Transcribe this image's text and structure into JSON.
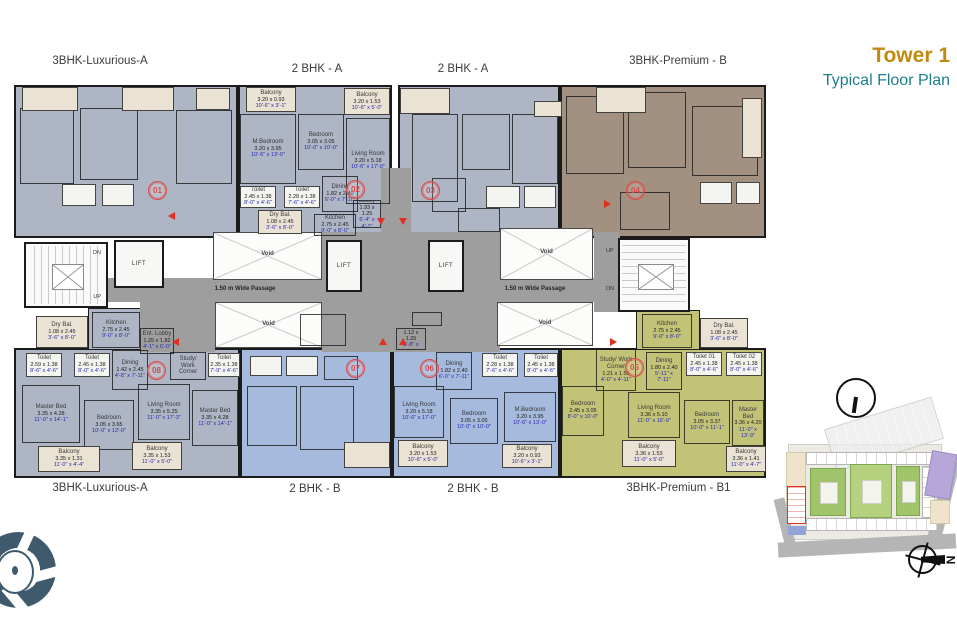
{
  "title": {
    "tower": "Tower 1",
    "plan": "Typical Floor Plan"
  },
  "unit_types": {
    "top": [
      "3BHK-Luxurious-A",
      "2 BHK - A",
      "2 BHK - A",
      "3BHK-Premium - B"
    ],
    "bottom": [
      "3BHK-Luxurious-A",
      "2 BHK - B",
      "2 BHK - B",
      "3BHK-Premium - B1"
    ]
  },
  "core": {
    "lift": "LIFT",
    "void": "Void",
    "up": "UP",
    "dn": "DN",
    "passage": "1.50 m Wide Passage",
    "north": "N"
  },
  "colors": {
    "slate_unit": "#aeb5c4",
    "periwinkle_unit": "#a6bade",
    "brown_unit": "#a29080",
    "olive_unit": "#c2c377",
    "balcony": "#eae2d3",
    "corridor": "#9e9e9e",
    "unit_badge": "#d84b4b",
    "imperial_dim": "#2929b0",
    "tower_gold": "#c08a10",
    "subtitle_teal": "#1e7d8d"
  },
  "units": [
    {
      "number": "01",
      "x": 148,
      "y": 181
    },
    {
      "number": "02",
      "x": 346,
      "y": 180
    },
    {
      "number": "03",
      "x": 421,
      "y": 181
    },
    {
      "number": "04",
      "x": 626,
      "y": 181
    },
    {
      "number": "05",
      "x": 625,
      "y": 358
    },
    {
      "number": "06",
      "x": 420,
      "y": 359
    },
    {
      "number": "07",
      "x": 346,
      "y": 359
    },
    {
      "number": "08",
      "x": 147,
      "y": 361
    }
  ],
  "arrows": [
    {
      "x": 377,
      "y": 218,
      "d": "down"
    },
    {
      "x": 399,
      "y": 218,
      "d": "down"
    },
    {
      "x": 379,
      "y": 338,
      "d": "up"
    },
    {
      "x": 399,
      "y": 338,
      "d": "up"
    },
    {
      "x": 168,
      "y": 212,
      "d": "left"
    },
    {
      "x": 604,
      "y": 200,
      "d": "right"
    },
    {
      "x": 610,
      "y": 338,
      "d": "right"
    },
    {
      "x": 172,
      "y": 338,
      "d": "left"
    }
  ],
  "rooms": [
    {
      "x": 20,
      "y": 108,
      "w": 54,
      "h": 76
    },
    {
      "x": 80,
      "y": 108,
      "w": 58,
      "h": 72
    },
    {
      "x": 176,
      "y": 110,
      "w": 56,
      "h": 74
    },
    {
      "x": 62,
      "y": 184,
      "w": 34,
      "h": 22,
      "b": "w"
    },
    {
      "x": 102,
      "y": 184,
      "w": 32,
      "h": 22,
      "b": "w"
    },
    {
      "x": 22,
      "y": 87,
      "w": 56,
      "h": 24,
      "b": "b"
    },
    {
      "x": 122,
      "y": 87,
      "w": 52,
      "h": 24,
      "b": "b"
    },
    {
      "x": 196,
      "y": 88,
      "w": 34,
      "h": 22,
      "b": "b"
    },
    {
      "x": 246,
      "y": 87,
      "w": 50,
      "h": 25,
      "b": "b",
      "n": "Balcony",
      "m": "3.20 x 0.93",
      "f": "10'-6\" x 3'-1\""
    },
    {
      "x": 344,
      "y": 88,
      "w": 46,
      "h": 27,
      "b": "b",
      "n": "Balcony",
      "m": "3.20 x 1.53",
      "f": "10'-6\" x 5'-0\""
    },
    {
      "x": 240,
      "y": 114,
      "w": 56,
      "h": 70,
      "n": "M.Bedroom",
      "m": "3.20 x 3.95",
      "f": "10'-6\" x 13'-0\""
    },
    {
      "x": 298,
      "y": 114,
      "w": 46,
      "h": 56,
      "n": "Bedroom",
      "m": "3.05 x 3.05",
      "f": "10'-0\" x 10'-0\""
    },
    {
      "x": 346,
      "y": 118,
      "w": 44,
      "h": 86,
      "n": "Living Room",
      "m": "3.20 x 5.18",
      "f": "10'-6\" x 17'-0\""
    },
    {
      "x": 240,
      "y": 186,
      "w": 36,
      "h": 22,
      "b": "w",
      "n": "Toilet",
      "m": "2.45 x 1.38",
      "f": "8'-0\" x 4'-6\""
    },
    {
      "x": 284,
      "y": 186,
      "w": 36,
      "h": 22,
      "b": "w",
      "n": "Toilet",
      "m": "2.28 x 1.38",
      "f": "7'-6\" x 4'-6\""
    },
    {
      "x": 322,
      "y": 176,
      "w": 36,
      "h": 36,
      "n": "Dining",
      "m": "1.82 x 2.40",
      "f": "6'-0\" x 7'-11\""
    },
    {
      "x": 258,
      "y": 210,
      "w": 44,
      "h": 24,
      "b": "b",
      "n": "Dry Bal.",
      "m": "1.08 x 2.45",
      "f": "3'-6\" x 8'-0\""
    },
    {
      "x": 314,
      "y": 214,
      "w": 42,
      "h": 22,
      "n": "Kitchen",
      "m": "2.75 x 2.45",
      "f": "9'-0\" x 8'-0\""
    },
    {
      "x": 353,
      "y": 200,
      "w": 28,
      "h": 28,
      "n": "Lobby",
      "m": "1.93 x 1.25",
      "f": "6'-4\" x 4'-1\""
    },
    {
      "x": 412,
      "y": 114,
      "w": 46,
      "h": 88
    },
    {
      "x": 462,
      "y": 114,
      "w": 48,
      "h": 56
    },
    {
      "x": 512,
      "y": 114,
      "w": 46,
      "h": 70
    },
    {
      "x": 486,
      "y": 186,
      "w": 34,
      "h": 22,
      "b": "w"
    },
    {
      "x": 524,
      "y": 186,
      "w": 32,
      "h": 22,
      "b": "w"
    },
    {
      "x": 432,
      "y": 178,
      "w": 34,
      "h": 34
    },
    {
      "x": 458,
      "y": 208,
      "w": 42,
      "h": 24
    },
    {
      "x": 400,
      "y": 88,
      "w": 50,
      "h": 26,
      "b": "b"
    },
    {
      "x": 534,
      "y": 101,
      "w": 28,
      "h": 16,
      "b": "b"
    },
    {
      "x": 566,
      "y": 96,
      "w": 58,
      "h": 78
    },
    {
      "x": 628,
      "y": 92,
      "w": 58,
      "h": 76
    },
    {
      "x": 692,
      "y": 106,
      "w": 66,
      "h": 70
    },
    {
      "x": 700,
      "y": 182,
      "w": 32,
      "h": 22,
      "b": "w"
    },
    {
      "x": 736,
      "y": 182,
      "w": 24,
      "h": 22,
      "b": "w"
    },
    {
      "x": 620,
      "y": 192,
      "w": 50,
      "h": 38
    },
    {
      "x": 596,
      "y": 87,
      "w": 50,
      "h": 26,
      "b": "b"
    },
    {
      "x": 742,
      "y": 98,
      "w": 20,
      "h": 60,
      "b": "b"
    },
    {
      "x": 26,
      "y": 353,
      "w": 36,
      "h": 24,
      "b": "w",
      "n": "Toilet",
      "m": "2.59 x 1.38",
      "f": "8'-6\" x 4'-6\""
    },
    {
      "x": 74,
      "y": 353,
      "w": 36,
      "h": 24,
      "b": "w",
      "n": "Toilet",
      "m": "2.45 x 1.38",
      "f": "8'-0\" x 4'-6\""
    },
    {
      "x": 112,
      "y": 350,
      "w": 36,
      "h": 40,
      "n": "Dining",
      "m": "1.42 x 2.45",
      "f": "4'-8\" x 7'-11\""
    },
    {
      "x": 170,
      "y": 352,
      "w": 36,
      "h": 28,
      "n": "Study/ Work Corner"
    },
    {
      "x": 208,
      "y": 353,
      "w": 32,
      "h": 24,
      "b": "w",
      "n": "Toilet",
      "m": "2.35 x 1.38",
      "f": "7'-9\" x 4'-6\""
    },
    {
      "x": 22,
      "y": 385,
      "w": 58,
      "h": 58,
      "n": "Master Bed",
      "m": "3.35 x 4.28",
      "f": "11'-0\" x 14'-1\""
    },
    {
      "x": 84,
      "y": 400,
      "w": 50,
      "h": 50,
      "n": "Bedroom",
      "m": "3.05 x 3.65",
      "f": "10'-0\" x 12'-0\""
    },
    {
      "x": 138,
      "y": 384,
      "w": 52,
      "h": 56,
      "n": "Living Room",
      "m": "3.35 x 5.25",
      "f": "11'-0\" x 17'-3\""
    },
    {
      "x": 192,
      "y": 390,
      "w": 46,
      "h": 56,
      "n": "Master Bed",
      "m": "3.35 x 4.28",
      "f": "11'-0\" x 14'-1\""
    },
    {
      "x": 38,
      "y": 446,
      "w": 62,
      "h": 26,
      "b": "b",
      "n": "Balcony",
      "m": "3.35 x 1.31",
      "f": "11'-0\" x 4'-4\""
    },
    {
      "x": 132,
      "y": 442,
      "w": 50,
      "h": 28,
      "b": "b",
      "n": "Balcony",
      "m": "3.35 x 1.53",
      "f": "11'-0\" x 5'-0\""
    },
    {
      "x": 140,
      "y": 328,
      "w": 34,
      "h": 26,
      "n": "Ent. Lobby",
      "m": "1.25 x 1.82",
      "f": "4'-1\" x 6'-0\""
    },
    {
      "x": 92,
      "y": 312,
      "w": 48,
      "h": 36,
      "n": "Kitchen",
      "m": "2.75 x 2.45",
      "f": "9'-0\" x 8'-0\""
    },
    {
      "x": 36,
      "y": 316,
      "w": 52,
      "h": 32,
      "b": "b",
      "n": "Dry Bal.",
      "m": "1.08 x 2.45",
      "f": "3'-6\" x 8'-0\""
    },
    {
      "x": 247,
      "y": 386,
      "w": 50,
      "h": 60
    },
    {
      "x": 300,
      "y": 386,
      "w": 54,
      "h": 64
    },
    {
      "x": 250,
      "y": 356,
      "w": 32,
      "h": 20,
      "b": "w"
    },
    {
      "x": 286,
      "y": 356,
      "w": 32,
      "h": 20,
      "b": "w"
    },
    {
      "x": 324,
      "y": 356,
      "w": 34,
      "h": 24
    },
    {
      "x": 300,
      "y": 314,
      "w": 46,
      "h": 32
    },
    {
      "x": 344,
      "y": 442,
      "w": 46,
      "h": 26,
      "b": "b"
    },
    {
      "x": 436,
      "y": 352,
      "w": 36,
      "h": 38,
      "n": "Dining",
      "m": "1.82 x 2.40",
      "f": "6'-0\" x 7'-11\""
    },
    {
      "x": 482,
      "y": 353,
      "w": 36,
      "h": 24,
      "b": "w",
      "n": "Toilet",
      "m": "2.28 x 1.38",
      "f": "7'-6\" x 4'-6\""
    },
    {
      "x": 524,
      "y": 353,
      "w": 34,
      "h": 24,
      "b": "w",
      "n": "Toilet",
      "m": "2.45 x 1.38",
      "f": "8'-0\" x 4'-6\""
    },
    {
      "x": 394,
      "y": 386,
      "w": 50,
      "h": 52,
      "n": "Living Room",
      "m": "3.20 x 5.18",
      "f": "10'-6\" x 17'-0\""
    },
    {
      "x": 450,
      "y": 398,
      "w": 48,
      "h": 46,
      "n": "Bedroom",
      "m": "3.05 x 3.05",
      "f": "10'-0\" x 10'-0\""
    },
    {
      "x": 504,
      "y": 392,
      "w": 52,
      "h": 50,
      "n": "M.Bedroom",
      "m": "3.20 x 3.95",
      "f": "10'-6\" x 13'-0\""
    },
    {
      "x": 398,
      "y": 440,
      "w": 50,
      "h": 27,
      "b": "b",
      "n": "Balcony",
      "m": "3.20 x 1.53",
      "f": "10'-6\" x 5'-0\""
    },
    {
      "x": 502,
      "y": 444,
      "w": 50,
      "h": 24,
      "b": "b",
      "n": "Balcony",
      "m": "3.20 x 0.93",
      "f": "10'-6\" x 3'-1\""
    },
    {
      "x": 396,
      "y": 328,
      "w": 30,
      "h": 22,
      "n": "Lobby",
      "m": "1.12 x 1.25",
      "f": "3'-8\" x 4'-1\""
    },
    {
      "x": 412,
      "y": 312,
      "w": 30,
      "h": 14
    },
    {
      "x": 642,
      "y": 314,
      "w": 50,
      "h": 34,
      "n": "Kitchen",
      "m": "2.75 x 2.45",
      "f": "9'-0\" x 8'-0\""
    },
    {
      "x": 700,
      "y": 318,
      "w": 48,
      "h": 30,
      "b": "b",
      "n": "Dry Bal.",
      "m": "1.08 x 2.45",
      "f": "3'-6\" x 8'-0\""
    },
    {
      "x": 596,
      "y": 349,
      "w": 40,
      "h": 42,
      "n": "Study/ Work Corner",
      "m": "1.21 x 1.50",
      "f": "4'-0\" x 4'-11\""
    },
    {
      "x": 646,
      "y": 352,
      "w": 36,
      "h": 38,
      "n": "Dining",
      "m": "1.80 x 2.40",
      "f": "5'-11\" x 7'-11\""
    },
    {
      "x": 686,
      "y": 352,
      "w": 36,
      "h": 24,
      "b": "w",
      "n": "Toilet 01",
      "m": "2.45 x 1.38",
      "f": "8'-0\" x 4'-6\""
    },
    {
      "x": 726,
      "y": 352,
      "w": 36,
      "h": 24,
      "b": "w",
      "n": "Toilet 02",
      "m": "2.45 x 1.38",
      "f": "8'-0\" x 4'-6\""
    },
    {
      "x": 562,
      "y": 386,
      "w": 42,
      "h": 50,
      "n": "Bedroom",
      "m": "2.45 x 3.05",
      "f": "8'-0\" x 10'-0\""
    },
    {
      "x": 628,
      "y": 392,
      "w": 52,
      "h": 46,
      "n": "Living Room",
      "m": "3.36 x 5.10",
      "f": "11'-0\" x 16'-9\""
    },
    {
      "x": 684,
      "y": 400,
      "w": 46,
      "h": 44,
      "n": "Bedroom",
      "m": "3.05 x 3.37",
      "f": "10'-0\" x 11'-1\""
    },
    {
      "x": 732,
      "y": 400,
      "w": 32,
      "h": 46,
      "n": "Master Bed",
      "m": "3.36 x 4.20",
      "f": "11'-0\" x 13'-9\""
    },
    {
      "x": 622,
      "y": 440,
      "w": 54,
      "h": 27,
      "b": "b",
      "n": "Balcony",
      "m": "3.36 x 1.53",
      "f": "11'-0\" x 5'-0\""
    },
    {
      "x": 726,
      "y": 446,
      "w": 40,
      "h": 26,
      "b": "b",
      "n": "Balcony",
      "m": "3.36 x 1.41",
      "f": "11'-0\" x 4'-7\""
    }
  ]
}
